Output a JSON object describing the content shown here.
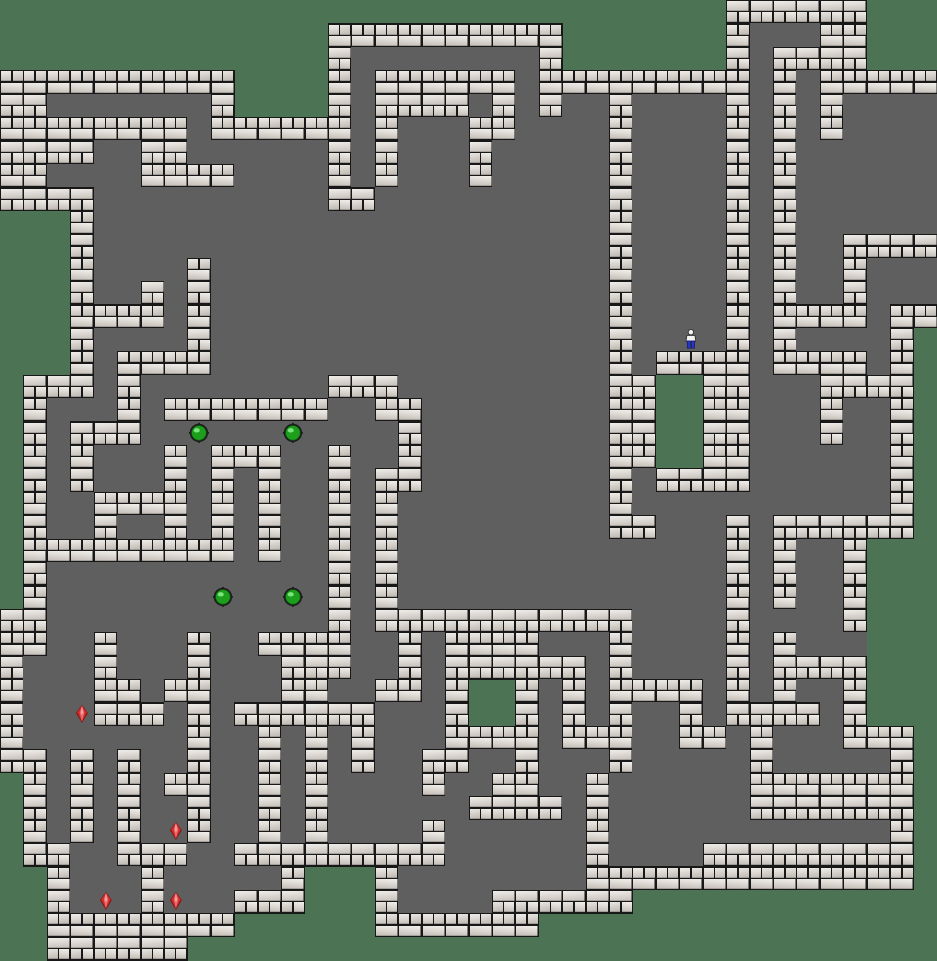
{
  "app": {
    "name": "sokoban-level-board"
  },
  "board": {
    "cols": 40,
    "rows": 41,
    "tile_width": 23.425,
    "tile_height": 23.415,
    "legend": {
      "#": "wall",
      ".": "floor",
      " ": "outside",
      "$": "box-ball",
      "*": "goal-ruby",
      "@": "player"
    },
    "counts": {
      "boxes": 4,
      "goals": 4,
      "players": 1
    },
    "map": [
      "                               ######    ",
      "              ##########       #...##   ",
      "              #........#       #.####   ",
      "##########    #.######.#########.#.#####",
      "##.......#    #.####.#.#..#....#.#.#....",
      "########.######.#...##....#....#.#.#....",
      "####..##......#.#...#.....#....#.#......",
      "##....####....#.#...#.....#....#.#......",
      "####..........##..........#....#.#......",
      "   #......................#....#.#......",
      "   #......................#....#.#..####",
      "   #....#.................#....#.#..#...",
      "   #..#.#.................#....#.#..#...",
      "   ####.#.................#....#.####.##",
      "   #....#.................#..@.#.#....# ",
      "   #.####.................#.####.####.# ",
      " ###.#........###.........##  ##...#### ",
      " #...#.#######..##........##  ##...#..# ",
      " #.###..$...$....#........##  ##...#..# ",
      " #.#...#.###..#..#........##  ##......# ",
      " #.#...#.#.#..#.##........#.####......# ",
      " #..####.#.#..#.#.........#...........# ",
      " #..#..#.#.#..#.#.........##...#.###### ",
      " #########.#..#.#..............#.#..#   ",
      " #............#.#..............#.#..#   ",
      " #.......$..$.#.#..............#.#..#   ",
      "##............#.###########....#....#   ",
      "##..#...#..####..#.####...#....#.#...   ",
      "#...#...#...###..#.######.#....#.####   ",
      "#...##.##...##..##.#  #.#.####.#.#..#   ",
      "#..*###.#.######...#  #.#.#..#.####.#   ",
      "#.......#..#.#.#...####.###..##.#...### ",
      "##.#.#..#..#.#.#..##..#...#.....#.....# ",
      " #.#.#.##..#.#....#..##..#......####### ",
      " #.#.#..#..#.#......####.#......####### ",
      " #.#.#.*#..#.#....#......#............# ",
      " ##..###..#########......#....######### ",
      "  #...#.....#   #........############## ",
      "  #.*.#*..###   #....######             ",
      "  ########      #######                 ",
      "  ######                                "
    ]
  },
  "entities": {
    "player": {
      "col": 29,
      "row": 14
    },
    "boxes": [
      {
        "col": 8,
        "row": 18
      },
      {
        "col": 12,
        "row": 18
      },
      {
        "col": 9,
        "row": 25
      },
      {
        "col": 12,
        "row": 25
      }
    ],
    "goals": [
      {
        "col": 3,
        "row": 30
      },
      {
        "col": 7,
        "row": 35
      },
      {
        "col": 4,
        "row": 38
      },
      {
        "col": 7,
        "row": 38
      }
    ]
  },
  "colors": {
    "outside_green": "#4c7454",
    "floor_gray": "#5f5f5f",
    "grout_dark": "#181818",
    "brick_light": "#f0eeea",
    "brick_shade": "#c6c0ba",
    "box_green": "#1d9e1d",
    "box_green_dark": "#0b6c0b",
    "box_highlight": "#8df08d",
    "box_ring": "#1d1d1d",
    "ruby_red": "#cf2b2b",
    "ruby_red_dark": "#7e1010",
    "player_shirt": "#f2f2f2",
    "player_pants": "#2736c4",
    "player_outline": "#333333"
  }
}
